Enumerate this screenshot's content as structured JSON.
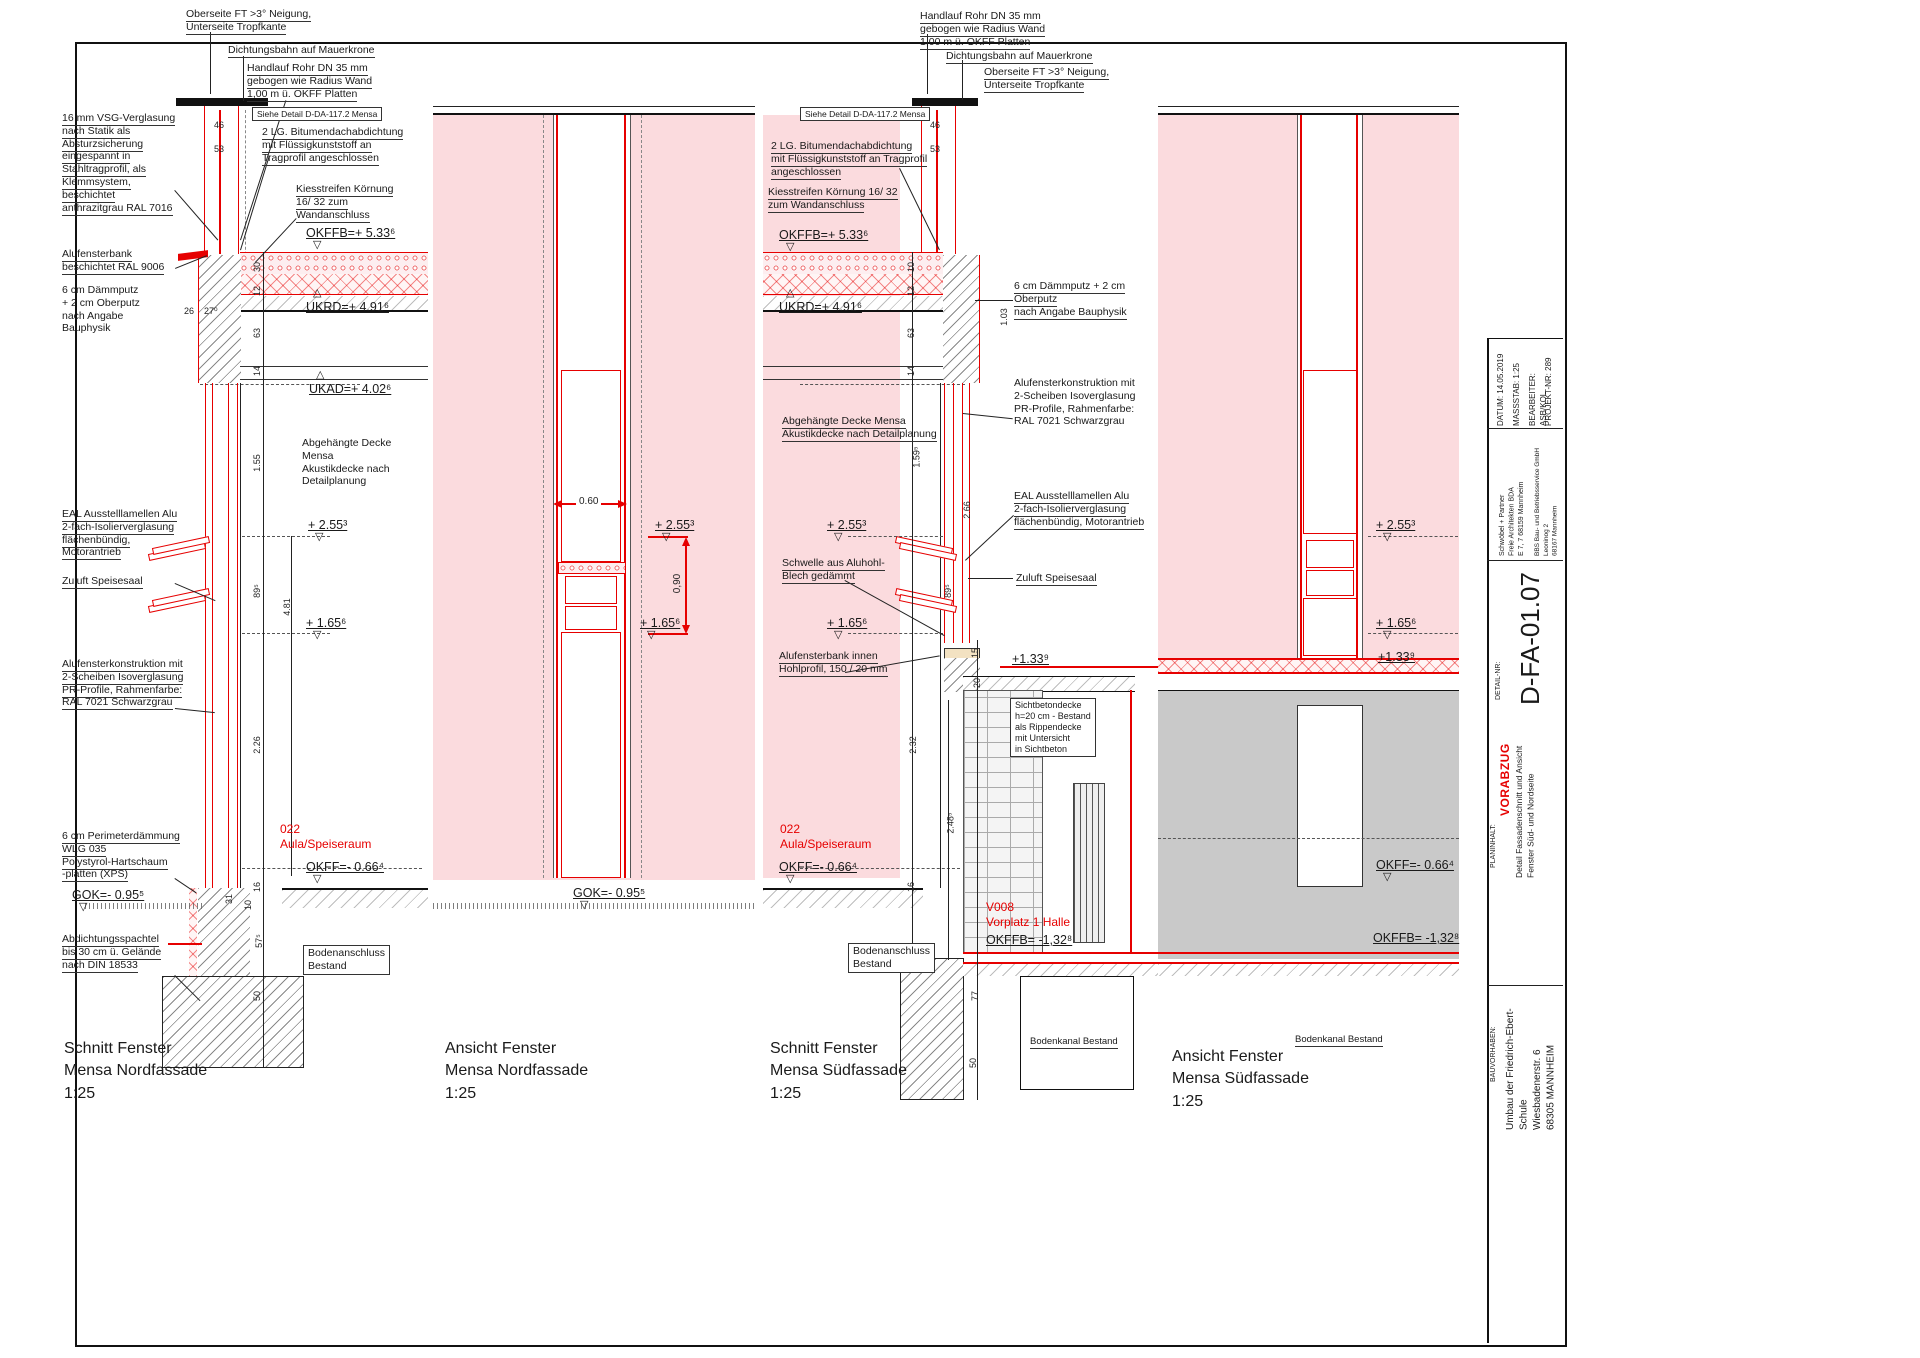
{
  "p1": {
    "title": "Schnitt Fenster\nMensa Nordfassade\n1:25",
    "a_oberseite": "Oberseite FT >3° Neigung,\nUnterseite Tropfkante",
    "a_dichtung": "Dichtungsbahn auf Mauerkrone",
    "a_handlauf": "Handlauf Rohr DN 35 mm\ngebogen wie Radius Wand\n1,00 m ü. OKFF Platten",
    "a_siehe": "Siehe Detail D-DA-117.2  Mensa",
    "a_bitumen": "2 LG. Bitumendachabdichtung\nmit Flüssigkunststoff an\nTragprofil angeschlossen",
    "a_kies": "Kiesstreifen Körnung\n16/ 32 zum\nWandanschluss",
    "e_okffb": "OKFFB=+ 5.33⁶",
    "e_ukrd": "UKRD=+ 4.91⁶",
    "e_ukad": "UKAD=+ 4.02⁶",
    "a_decke": "Abgehängte Decke\nMensa\nAkustikdecke nach\nDetailplanung",
    "e_255": "+ 2.55³",
    "e_165": "+ 1.65⁶",
    "room": "022\nAula/Speiseraum",
    "e_okff": "OKFF=- 0.66⁴",
    "a_boden": "Bodenanschluss\nBestand",
    "a_vsg": "16 mm VSG-Verglasung\nnach Statik als\nAbsturzsicherung\neingespannt in\nStahltragprofil, als\nKlemmsystem, beschichtet\nanthrazitgrau RAL 7016",
    "a_bank": "Alufensterbank\nbeschichtet RAL 9006",
    "a_daemmputz": "6 cm Dämmputz\n+ 2 cm Oberputz\nnach Angabe\nBauphysik",
    "a_eal": "EAL Ausstelllamellen Alu\n2-fach-Isolierverglasung\nflächenbündig,\nMotorantrieb",
    "a_zuluft": "Zuluft Speisesaal",
    "a_alukon": "Alufensterkonstruktion mit\n2-Scheiben Isoverglasung\nPR-Profile, Rahmenfarbe:\nRAL 7021 Schwarzgrau",
    "a_perimeter": "6 cm Perimeterdämmung\nWLG 035\nPolystyrol-Hartschaum\n-platten (XPS)",
    "e_gok": "GOK=- 0.95⁵",
    "a_abdichtung": "Abdichtungsspachtel\nbis 30 cm ü. Gelände\nnach DIN 18533",
    "dims": {
      "d46": "46",
      "d53": "53",
      "d26": "26",
      "d27": "27⁰",
      "d30": "30",
      "d12": "12",
      "d63": "63",
      "d14": "14",
      "d155": "1.55",
      "d89": "89⁵",
      "d481": "4.81",
      "d226": "2.26",
      "d16": "16",
      "d10": "10",
      "d31": "31",
      "d57": "57⁵",
      "d50": "50"
    }
  },
  "p2": {
    "title": "Ansicht Fenster\nMensa Nordfassade\n1:25",
    "d060": "0.60",
    "d090": "0,90",
    "e_255": "+ 2.55³",
    "e_165": "+ 1.65⁶",
    "e_gok": "GOK=- 0.95⁵"
  },
  "p3": {
    "title": "Schnitt Fenster\nMensa Südfassade\n1:25",
    "a_handlauf": "Handlauf Rohr DN 35 mm\ngebogen wie Radius Wand\n1,00 m ü. OKFF Platten",
    "a_dichtung": "Dichtungsbahn auf Mauerkrone",
    "a_oberseite": "Oberseite FT >3° Neigung,\nUnterseite Tropfkante",
    "a_siehe": "Siehe Detail D-DA-117.2  Mensa",
    "a_bitumen": "2 LG. Bitumendachabdichtung\nmit Flüssigkunststoff an Tragprofil\nangeschlossen",
    "a_kies": "Kiesstreifen Körnung 16/ 32\nzum Wandanschluss",
    "e_okffb": "OKFFB=+ 5.33⁶",
    "e_ukrd": "UKRD=+ 4.91⁶",
    "a_daemmputz": "6 cm Dämmputz + 2 cm\nOberputz\nnach Angabe Bauphysik",
    "a_alukon": "Alufensterkonstruktion mit\n2-Scheiben Isoverglasung\nPR-Profile, Rahmenfarbe:\nRAL 7021 Schwarzgrau",
    "a_decke": "Abgehängte Decke Mensa\nAkustikdecke nach Detailplanung",
    "a_eal": "EAL Ausstelllamellen Alu\n2-fach-Isolierverglasung\nflächenbündig, Motorantrieb",
    "e_255": "+ 2.55³",
    "a_schwelle": "Schwelle aus Aluhohl-\nBlech gedämmt",
    "a_zuluft": "Zuluft Speisesaal",
    "e_165": "+ 1.65⁶",
    "a_bank_innen": "Alufensterbank innen\nHohlprofil, 150 / 20 mm",
    "e_133": "+1.33⁹",
    "a_sichtbeton": "Sichtbetondecke\nh=20 cm - Bestand\nals Rippendecke\nmit Untersicht\nin Sichtbeton",
    "room": "022\nAula/Speiseraum",
    "e_okff": "OKFF=- 0.66⁴",
    "room2": "V008\nVorplatz 1 Halle",
    "e_okffb2": "OKFFB= -1,32⁸",
    "a_boden": "Bodenanschluss\nBestand",
    "a_bodenkanal": "Bodenkanal Bestand",
    "dims": {
      "d46": "46",
      "d53": "53",
      "d10": "10",
      "d12": "12",
      "d63": "63",
      "d14": "14",
      "d103": "1.03",
      "d159": "1.59⁵",
      "d266": "2.66",
      "d89": "89⁵",
      "d15": "15",
      "d20": "20",
      "d232": "2.32",
      "d248": "2.48⁵",
      "d16": "16",
      "d77": "77",
      "d50": "50"
    }
  },
  "p4": {
    "title": "Ansicht Fenster\nMensa Südfassade\n1:25",
    "e_255": "+ 2.55³",
    "e_165": "+ 1.65⁶",
    "e_133": "+1.33⁹",
    "e_okff": "OKFF=- 0.66⁴",
    "e_okffb2": "OKFFB= -1,32⁸",
    "a_bodenkanal": "Bodenkanal Bestand"
  },
  "titleblock": {
    "projekt": "PROJEKT-NR: 289",
    "bearbeiter": "BEARBEITER:  ASB/KOL",
    "massstab": "MASSSTAB: 1:25",
    "datum": "DATUM: 14.05.2019",
    "firm1": "BBS Bau- und Betriebsservice GmbH\nLeoninog 2\n68167 Mannheim",
    "firm2": "Schwöbel + Partner\nFreie Architekten BDA\nE 7, 7    68159 Mannheim",
    "detail_label": "DETAIL-NR:",
    "detail_nr": "D-FA-01.07",
    "vorabzug": "VORABZUG",
    "planinhalt_label": "PLANINHALT:",
    "planinhalt": "Detail Fassadenschnitt und Ansicht\nFenster Süd- und Nordseite",
    "bauvorhaben_label": "BAUVORHABEN:",
    "bauvorhaben": "Umbau der Friedrich-Ebert-Schule\nWiesbadenerstr. 6\n68305 MANNHEIM"
  },
  "colors": {
    "red": "#e60000",
    "pink": "#fbdbde",
    "gray": "#c9c9c9"
  }
}
